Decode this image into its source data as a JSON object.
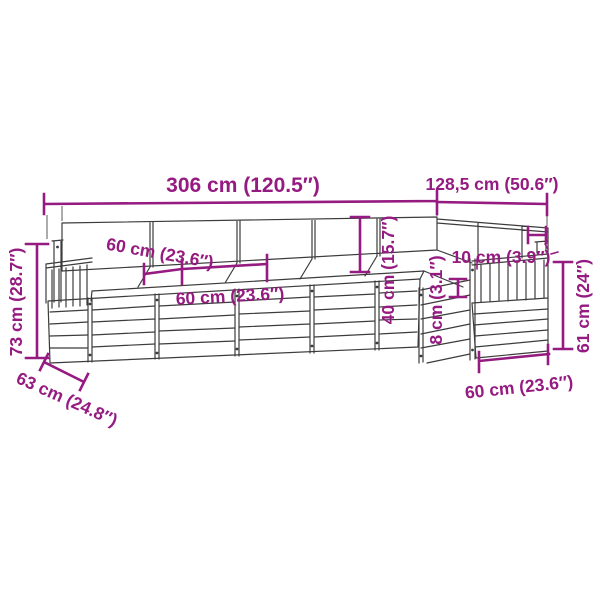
{
  "diagram": {
    "colors": {
      "dimension": "#951b81",
      "line": "#3c3c3c",
      "background": "#ffffff"
    },
    "dimensions": {
      "total_width": "306 cm (120.5″)",
      "wing_width": "128,5 cm (50.6″)",
      "overall_height": "73 cm (28.7″)",
      "overall_depth": "63 cm (24.8″)",
      "seat_depth": "60 cm (23.6″)",
      "seat_width": "60 cm (23.6″)",
      "backrest_height": "40 cm (15.7″)",
      "armrest_clearance": "8 cm (3.1″)",
      "armrest_width": "10 cm (3.9″)",
      "side_height": "61 cm (24″)",
      "end_seat_width": "60 cm (23.6″)"
    }
  }
}
